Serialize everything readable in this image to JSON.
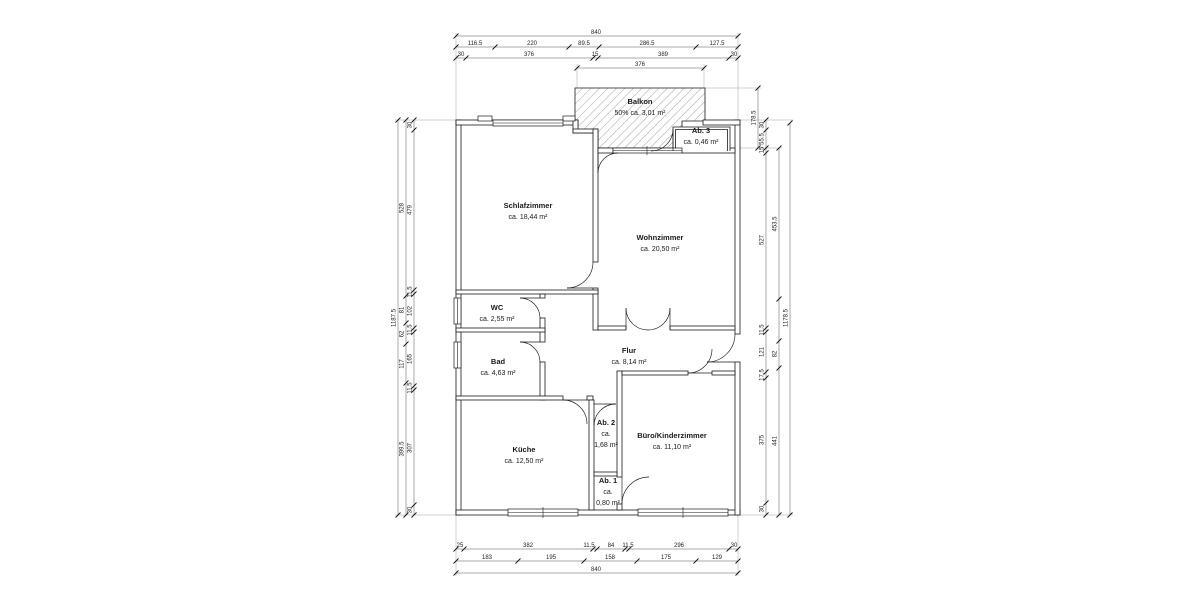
{
  "plan": {
    "rooms": [
      {
        "name": "Schlafzimmer",
        "lines": [
          "ca. 18,44 m²"
        ],
        "x": 528,
        "y": 208
      },
      {
        "name": "Wohnzimmer",
        "lines": [
          "ca. 20,50 m²"
        ],
        "x": 660,
        "y": 240
      },
      {
        "name": "WC",
        "lines": [
          "ca. 2,55 m²"
        ],
        "x": 497,
        "y": 310
      },
      {
        "name": "Bad",
        "lines": [
          "ca. 4,63 m²"
        ],
        "x": 498,
        "y": 364
      },
      {
        "name": "Flur",
        "lines": [
          "ca. 8,14 m²"
        ],
        "x": 629,
        "y": 353
      },
      {
        "name": "Küche",
        "lines": [
          "ca. 12,50 m²"
        ],
        "x": 524,
        "y": 452
      },
      {
        "name": "Ab. 2",
        "lines": [
          "ca.",
          "1,68 m²"
        ],
        "x": 606,
        "y": 425
      },
      {
        "name": "Ab. 1",
        "lines": [
          "ca.",
          "0,80 m²"
        ],
        "x": 608,
        "y": 483
      },
      {
        "name": "Büro/Kinderzimmer",
        "lines": [
          "ca. 11,10 m²"
        ],
        "x": 672,
        "y": 438
      },
      {
        "name": "Balkon",
        "lines": [
          "50% ca. 3,01 m²"
        ],
        "x": 640,
        "y": 104
      },
      {
        "name": "Ab. 3",
        "lines": [
          "ca. 0,46 m²"
        ],
        "x": 701,
        "y": 133
      }
    ],
    "dim_lines": [
      {
        "dir": "h",
        "y": 36,
        "x1": 456,
        "x2": 738,
        "ticks": [
          456,
          738
        ],
        "labels": [
          {
            "t": "840",
            "x": 596
          }
        ]
      },
      {
        "dir": "h",
        "y": 47,
        "x1": 456,
        "x2": 738,
        "ticks": [
          456,
          495,
          569,
          599,
          696,
          738
        ],
        "labels": [
          {
            "t": "116.5",
            "x": 475
          },
          {
            "t": "220",
            "x": 532
          },
          {
            "t": "89.5",
            "x": 584
          },
          {
            "t": "286.5",
            "x": 647
          },
          {
            "t": "127.5",
            "x": 717
          }
        ]
      },
      {
        "dir": "h",
        "y": 58,
        "x1": 456,
        "x2": 738,
        "ticks": [
          456,
          466,
          593,
          598,
          729,
          738
        ],
        "labels": [
          {
            "t": "30",
            "x": 461
          },
          {
            "t": "376",
            "x": 529
          },
          {
            "t": "15",
            "x": 595
          },
          {
            "t": "389",
            "x": 663
          },
          {
            "t": "30",
            "x": 734
          }
        ]
      },
      {
        "dir": "h",
        "y": 68,
        "x1": 577,
        "x2": 704,
        "ticks": [
          577,
          704
        ],
        "labels": [
          {
            "t": "376",
            "x": 640
          }
        ]
      },
      {
        "dir": "h",
        "y": 549,
        "x1": 456,
        "x2": 738,
        "ticks": [
          456,
          464,
          593,
          597,
          625,
          629,
          729,
          738
        ],
        "labels": [
          {
            "t": "25",
            "x": 460
          },
          {
            "t": "382",
            "x": 528
          },
          {
            "t": "11.5",
            "x": 589
          },
          {
            "t": "84",
            "x": 611
          },
          {
            "t": "11.5",
            "x": 628
          },
          {
            "t": "296",
            "x": 679
          },
          {
            "t": "30",
            "x": 734
          }
        ]
      },
      {
        "dir": "h",
        "y": 561,
        "x1": 456,
        "x2": 738,
        "ticks": [
          456,
          518,
          584,
          637,
          696,
          738
        ],
        "labels": [
          {
            "t": "183",
            "x": 487
          },
          {
            "t": "195",
            "x": 551
          },
          {
            "t": "158",
            "x": 610
          },
          {
            "t": "175",
            "x": 666
          },
          {
            "t": "129",
            "x": 717
          }
        ]
      },
      {
        "dir": "h",
        "y": 573,
        "x1": 456,
        "x2": 738,
        "ticks": [
          456,
          738
        ],
        "labels": [
          {
            "t": "840",
            "x": 596
          }
        ]
      },
      {
        "dir": "v",
        "x": 398,
        "y1": 120,
        "y2": 515,
        "ticks": [
          120,
          515
        ],
        "labels": [
          {
            "t": "1187.5",
            "y": 318
          }
        ]
      },
      {
        "dir": "v",
        "x": 406,
        "y1": 120,
        "y2": 515,
        "ticks": [
          120,
          296,
          323,
          344,
          383,
          515
        ],
        "labels": [
          {
            "t": "528",
            "y": 208
          },
          {
            "t": "81",
            "y": 310
          },
          {
            "t": "62",
            "y": 334
          },
          {
            "t": "117",
            "y": 364
          },
          {
            "t": "399.5",
            "y": 449
          }
        ]
      },
      {
        "dir": "v",
        "x": 414,
        "y1": 120,
        "y2": 515,
        "ticks": [
          120,
          130,
          290,
          294,
          328,
          332,
          386,
          390,
          505,
          515
        ],
        "labels": [
          {
            "t": "30",
            "y": 125
          },
          {
            "t": "479",
            "y": 210
          },
          {
            "t": "11.5",
            "y": 292
          },
          {
            "t": "102",
            "y": 311
          },
          {
            "t": "11.5",
            "y": 330
          },
          {
            "t": "165",
            "y": 359
          },
          {
            "t": "11.5",
            "y": 388
          },
          {
            "t": "307",
            "y": 448
          },
          {
            "t": "30",
            "y": 510
          }
        ]
      },
      {
        "dir": "v",
        "x": 758,
        "y1": 88,
        "y2": 148,
        "ticks": [
          88,
          148
        ],
        "labels": [
          {
            "t": "178.5",
            "y": 118
          }
        ]
      },
      {
        "dir": "v",
        "x": 766,
        "y1": 120,
        "y2": 515,
        "ticks": [
          120,
          130,
          148,
          153,
          328,
          332,
          372,
          378,
          503,
          515
        ],
        "labels": [
          {
            "t": "30",
            "y": 125
          },
          {
            "t": "55.5",
            "y": 139
          },
          {
            "t": "15",
            "y": 150
          },
          {
            "t": "527",
            "y": 240
          },
          {
            "t": "11.5",
            "y": 330
          },
          {
            "t": "121",
            "y": 352
          },
          {
            "t": "17.5",
            "y": 375
          },
          {
            "t": "375",
            "y": 440
          },
          {
            "t": "30",
            "y": 509
          }
        ]
      },
      {
        "dir": "v",
        "x": 779,
        "y1": 148,
        "y2": 515,
        "ticks": [
          148,
          299,
          341,
          368,
          515
        ],
        "labels": [
          {
            "t": "453.5",
            "y": 224
          },
          {
            "t": "82",
            "y": 354
          },
          {
            "t": "441",
            "y": 441
          }
        ]
      },
      {
        "dir": "v",
        "x": 790,
        "y1": 123,
        "y2": 515,
        "ticks": [
          123,
          515
        ],
        "labels": [
          {
            "t": "1178.5",
            "y": 318
          }
        ]
      }
    ]
  }
}
